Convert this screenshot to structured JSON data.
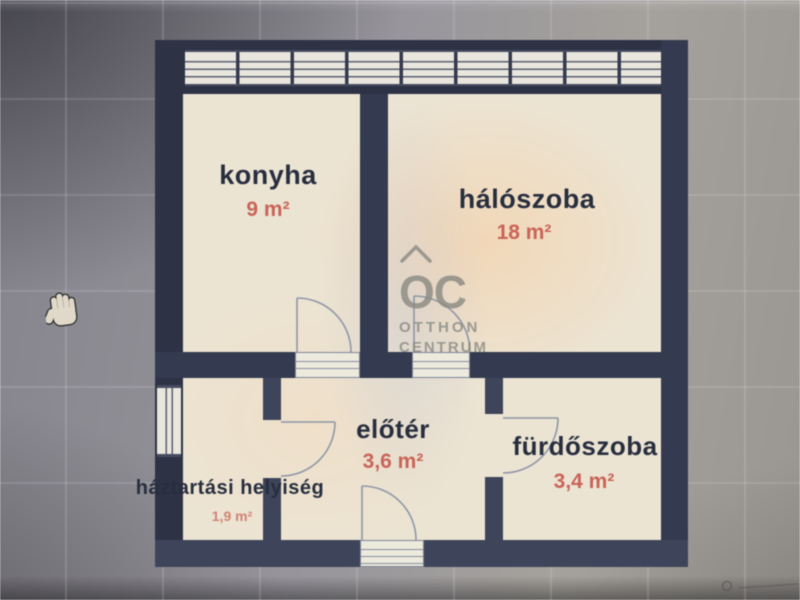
{
  "photo": {
    "description": "photographed floor plan displayed on a screen",
    "cursor": "open-hand-pan"
  },
  "watermark": {
    "logo": "OC",
    "name_line1": "OTTHON",
    "name_line2": "CENTRUM"
  },
  "rooms": [
    {
      "name": "konyha",
      "area": "9 m²"
    },
    {
      "name": "hálószoba",
      "area": "18 m²"
    },
    {
      "name": "előtér",
      "area": "3,6 m²"
    },
    {
      "name": "fürdőszoba",
      "area": "3,4 m²"
    },
    {
      "name": "háztartási helyiség",
      "area": "1,9 m²"
    }
  ],
  "colors": {
    "wall": "#343a4f",
    "floor": "#ece4d3",
    "room_name_text": "#272e3e",
    "area_text": "#c96458",
    "watermark_gray": "#8b8b83",
    "background_gray": "#98969c"
  }
}
